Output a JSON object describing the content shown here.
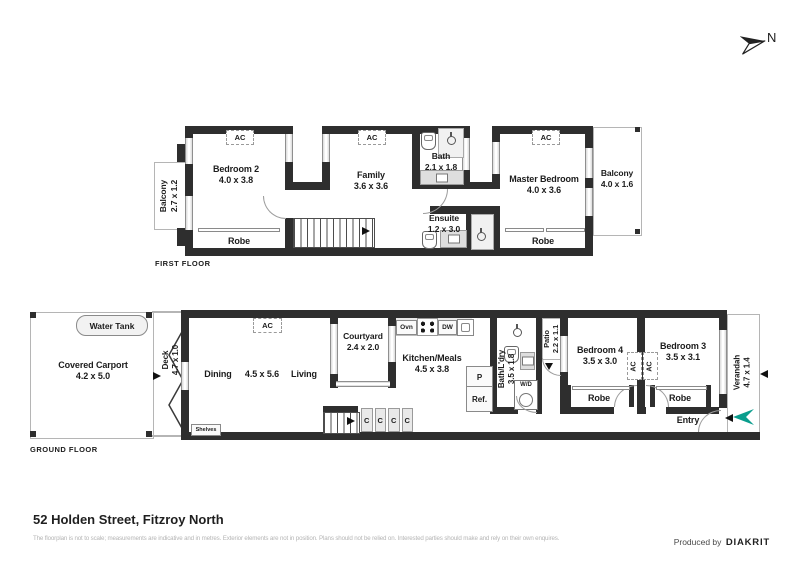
{
  "compass": {
    "north": "N"
  },
  "ff": {
    "floor_label": "FIRST FLOOR",
    "balcony_left_name": "Balcony",
    "balcony_left_dims": "2.7 x 1.2",
    "bedroom2_name": "Bedroom 2",
    "bedroom2_dims": "4.0 x 3.8",
    "family_name": "Family",
    "family_dims": "3.6 x 3.6",
    "bath_name": "Bath",
    "bath_dims": "2.1 x 1.8",
    "ensuite_name": "Ensuite",
    "ensuite_dims": "1.2 x 3.0",
    "master_name": "Master Bedroom",
    "master_dims": "4.0 x 3.6",
    "balcony_right_name": "Balcony",
    "balcony_right_dims": "4.0 x 1.6",
    "robe": "Robe",
    "ac": "AC"
  },
  "gf": {
    "floor_label": "GROUND FLOOR",
    "water_tank": "Water Tank",
    "carport_name": "Covered Carport",
    "carport_dims": "4.2 x 5.0",
    "deck_name": "Deck",
    "deck_dims": "4.7 x 1.0",
    "dining": "Dining",
    "living_dims": "4.5 x 5.6",
    "living": "Living",
    "shelves": "Shelves",
    "courtyard_name": "Courtyard",
    "courtyard_dims": "2.4 x 2.0",
    "kitchen_name": "Kitchen/Meals",
    "kitchen_dims": "4.5 x 3.8",
    "oven": "Ovn",
    "dishwasher": "DW",
    "pantry": "P",
    "fridge": "Ref.",
    "washer": "W/D",
    "cupboard": "C",
    "bath_laundry_name": "Bath/L'dry",
    "bath_laundry_dims": "3.5 x 1.8",
    "patio_name": "Patio",
    "patio_dims": "2.2 x 1.1",
    "bedroom4_name": "Bedroom 4",
    "bedroom4_dims": "3.5 x 3.0",
    "bedroom3_name": "Bedroom 3",
    "bedroom3_dims": "3.5 x 3.1",
    "verandah_name": "Verandah",
    "verandah_dims": "4.7 x 1.4",
    "entry": "Entry",
    "robe": "Robe",
    "ac": "AC"
  },
  "footer": {
    "title": "52 Holden Street, Fitzroy North",
    "disclaimer": "The floorplan is not to scale; measurements are indicative and in metres. Exterior elements are not in position. Plans should not be relied on. Interested parties should make and rely on their own enquires.",
    "produced_by": "Produced by",
    "brand": "DIAKRIT"
  },
  "colors": {
    "wall": "#2e2e2e",
    "entry_arrow": "#0a9d8d",
    "window": "#e2e2e2"
  }
}
